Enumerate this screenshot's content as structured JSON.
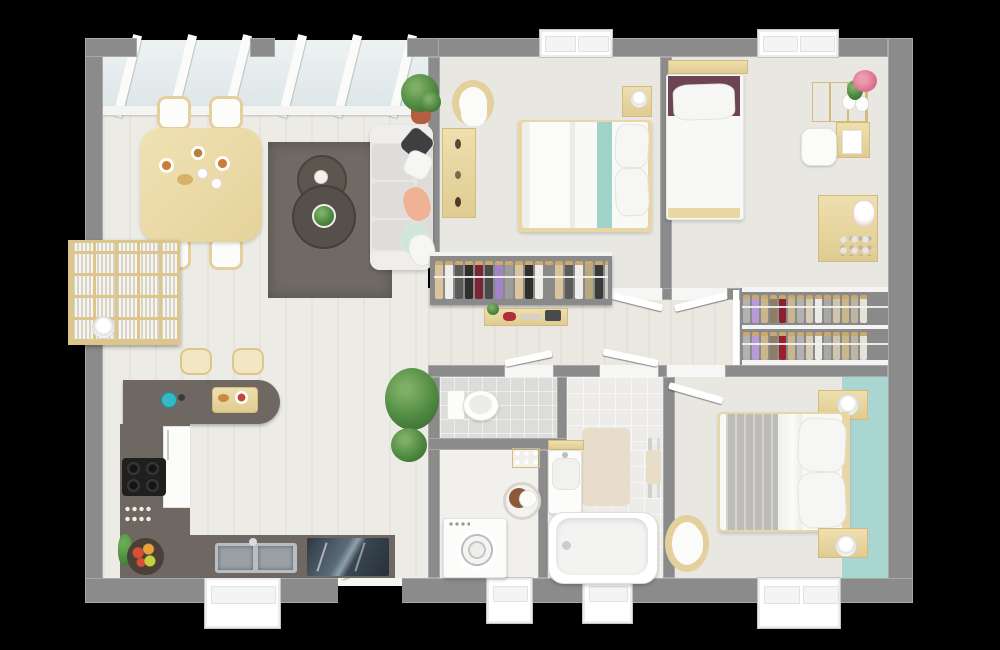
{
  "scene": {
    "type": "3d-floor-plan-top-view",
    "background": "#000000",
    "openings": {
      "skylight_panels": 6,
      "top_windows": 2,
      "bottom_windows": 4,
      "entry_door": 1,
      "interior_doors": 5
    }
  },
  "palette": {
    "outer_wall": "#8b8b8b",
    "floor_living": "#edebe5",
    "floor_bedroom": "#e9e7e2",
    "floor_hall": "#ebe8e1",
    "floor_tile": "#dcdcda",
    "wood_light": "#e9d8a6",
    "counter_taupe": "#6f6862",
    "rug_taupe": "#6f6a64",
    "coffee_table": "#56504a",
    "sofa_white": "#e7e6e3",
    "teal_stripe": "#9fd2c9",
    "teal_wall": "#aad6d2",
    "duvet_white": "#f7f7f5",
    "throw_gray": "#bdbcba",
    "pillow_maroon": "#6d4451",
    "pillow_peach": "#f0b294",
    "pillow_mint": "#cfe6da",
    "pillow_dark": "#3e3f41",
    "stove_black": "#1f1f1e",
    "sink_steel": "#b7bec2",
    "glass_dark": "#2e3742",
    "plant_green": "#4f8a41",
    "pot_terracotta": "#b25e3f",
    "closet_gray": "#8a8a8a",
    "mat_beige": "#e8ddcb",
    "kettle_teal": "#35b8c4"
  },
  "clothes": {
    "wardrobe_bedroom1": [
      "#d9c49c",
      "#efede9",
      "#5a5a58",
      "#2e2e2c",
      "#7c2433",
      "#4a4a48",
      "#a184c8",
      "#9c9c9a",
      "#d9c49c",
      "#2e2e2c",
      "#efede9",
      "#8a8a88",
      "#d9c49c",
      "#5a5a58",
      "#efede9",
      "#b9a87e",
      "#3a3a38",
      "#cfcecb"
    ],
    "closet_row_top": [
      "#b3b2b0",
      "#b59cd6",
      "#c9b68d",
      "#8d7b63",
      "#8c202e",
      "#c9b68d",
      "#b3b2b0",
      "#d6cbb4",
      "#eceae6",
      "#a9a8a6",
      "#cfc4ae",
      "#c9b68d",
      "#bdb4a2",
      "#e5e2da"
    ],
    "closet_row_bottom": [
      "#b3b2b0",
      "#b59cd6",
      "#c9b68d",
      "#8d7b63",
      "#9c1f2d",
      "#c9b68d",
      "#b3b2b0",
      "#d6cbb4",
      "#eceae6",
      "#a9a8a6",
      "#cfc4ae",
      "#c9b68d",
      "#bdb4a2",
      "#e5e2da"
    ]
  },
  "rooms": [
    {
      "name": "open-living-dining-kitchen",
      "furniture": [
        "dining-table",
        "dining-chairs",
        "area-rug",
        "nesting-coffee-tables",
        "sofa",
        "cube-bookshelf",
        "wall-lamp",
        "bar-stools",
        "kitchen-peninsula",
        "cooktop",
        "fridge",
        "sink-unit",
        "fruit-bowl",
        "potted-plants",
        "skylight-roof"
      ]
    },
    {
      "name": "bedroom-top-middle",
      "furniture": [
        "double-bed",
        "teal-runner",
        "armchair",
        "shelf-unit",
        "nightstand",
        "table-lamp",
        "open-wardrobe"
      ]
    },
    {
      "name": "bedroom-top-right",
      "furniture": [
        "single-bed",
        "headboard-shelf",
        "desk-with-hutch",
        "desk-chair",
        "flower-vases",
        "play-table",
        "toy-bunny"
      ]
    },
    {
      "name": "walk-in-closet",
      "furniture": [
        "clothes-rail-top",
        "clothes-rail-bottom"
      ]
    },
    {
      "name": "wc",
      "furniture": [
        "toilet"
      ]
    },
    {
      "name": "laundry-room",
      "furniture": [
        "washing-machine",
        "laundry-basket",
        "wall-shelf"
      ]
    },
    {
      "name": "bathroom",
      "furniture": [
        "vanity-sink",
        "bathtub",
        "towel-rail",
        "bath-mat"
      ]
    },
    {
      "name": "bedroom-bottom-right",
      "furniture": [
        "double-bed",
        "gray-throw",
        "nightstand-top",
        "nightstand-bottom",
        "table-lamps",
        "armchair",
        "teal-accent-wall"
      ]
    },
    {
      "name": "hallway",
      "furniture": [
        "console-bench"
      ]
    }
  ]
}
